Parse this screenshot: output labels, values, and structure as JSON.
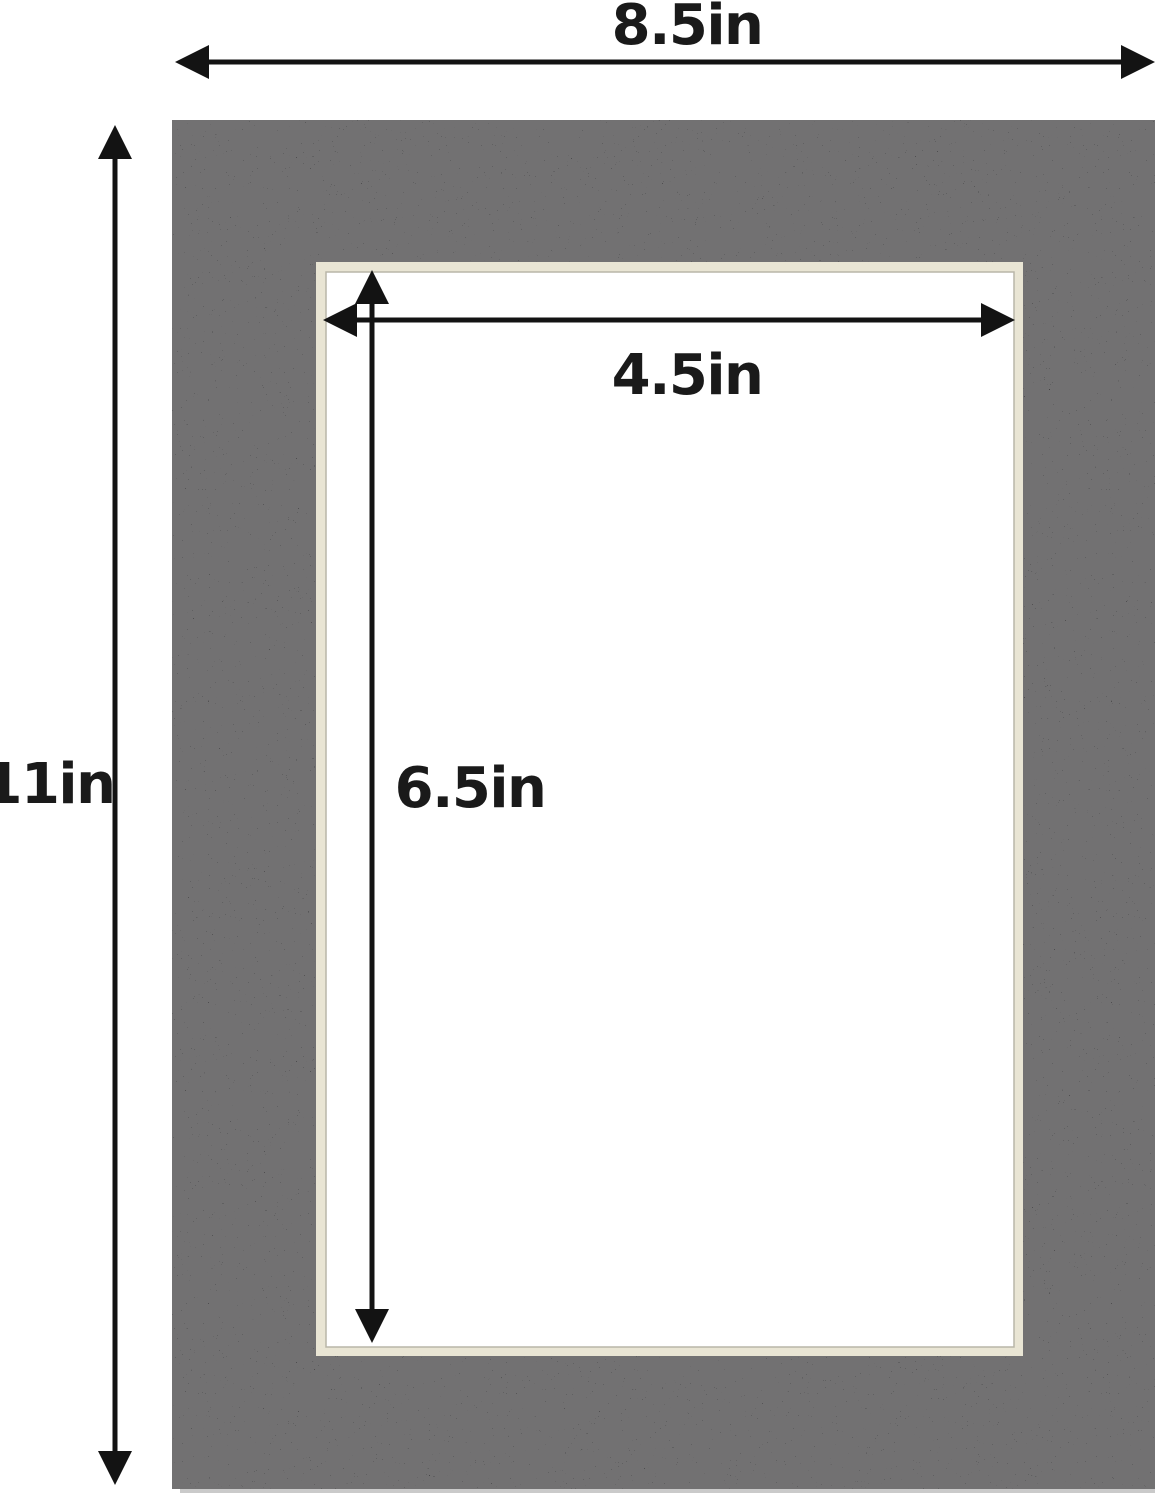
{
  "description": "Dimension diagram of a black picture mat board with a rectangular cut opening",
  "dimensions": {
    "outer_width": "8.5in",
    "outer_height": "11in",
    "opening_width": "4.5in",
    "opening_height": "6.5in"
  },
  "colors": {
    "background": "#ffffff",
    "mat": "#2c2b2d",
    "bevel": "#e9e5d4",
    "bevel_edge": "#b9b6a8",
    "opening": "#ffffff",
    "arrow": "#131313",
    "text": "#1a1a1a",
    "mat_shadow": "#9f9f9f"
  }
}
